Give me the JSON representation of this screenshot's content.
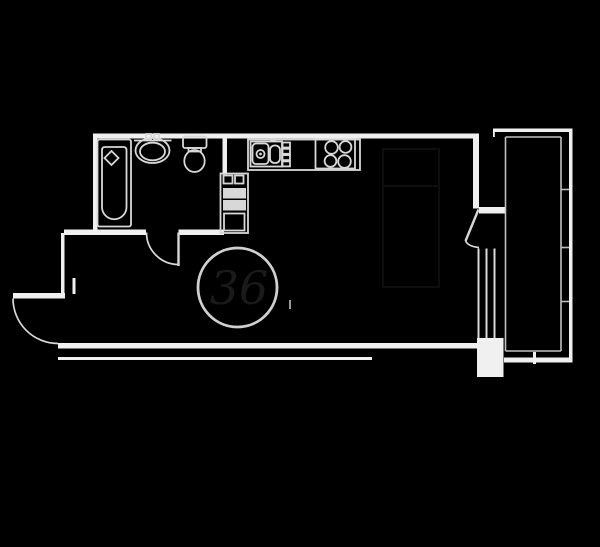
{
  "colors": {
    "background": "#000000",
    "wall": "#f0f0f0",
    "fixture": "#d8d8d8",
    "thin": "#c0c0c0",
    "table": "#d0d0d0",
    "faint_label": "#1a1a1a",
    "faint_furniture": "#0e0e0e"
  },
  "labels": {
    "table_marker": "36"
  },
  "plan": {
    "type": "studio-apartment-floor-plan",
    "fixtures": [
      "bathtub",
      "washbasin",
      "toilet",
      "washer-column",
      "kitchen-counter",
      "kitchen-sink",
      "drawer-unit",
      "stove",
      "dining-table",
      "entry-door",
      "bathroom-door",
      "balcony-door",
      "window",
      "balcony-glazing",
      "radiator-mark",
      "bed-faint-outline"
    ]
  }
}
